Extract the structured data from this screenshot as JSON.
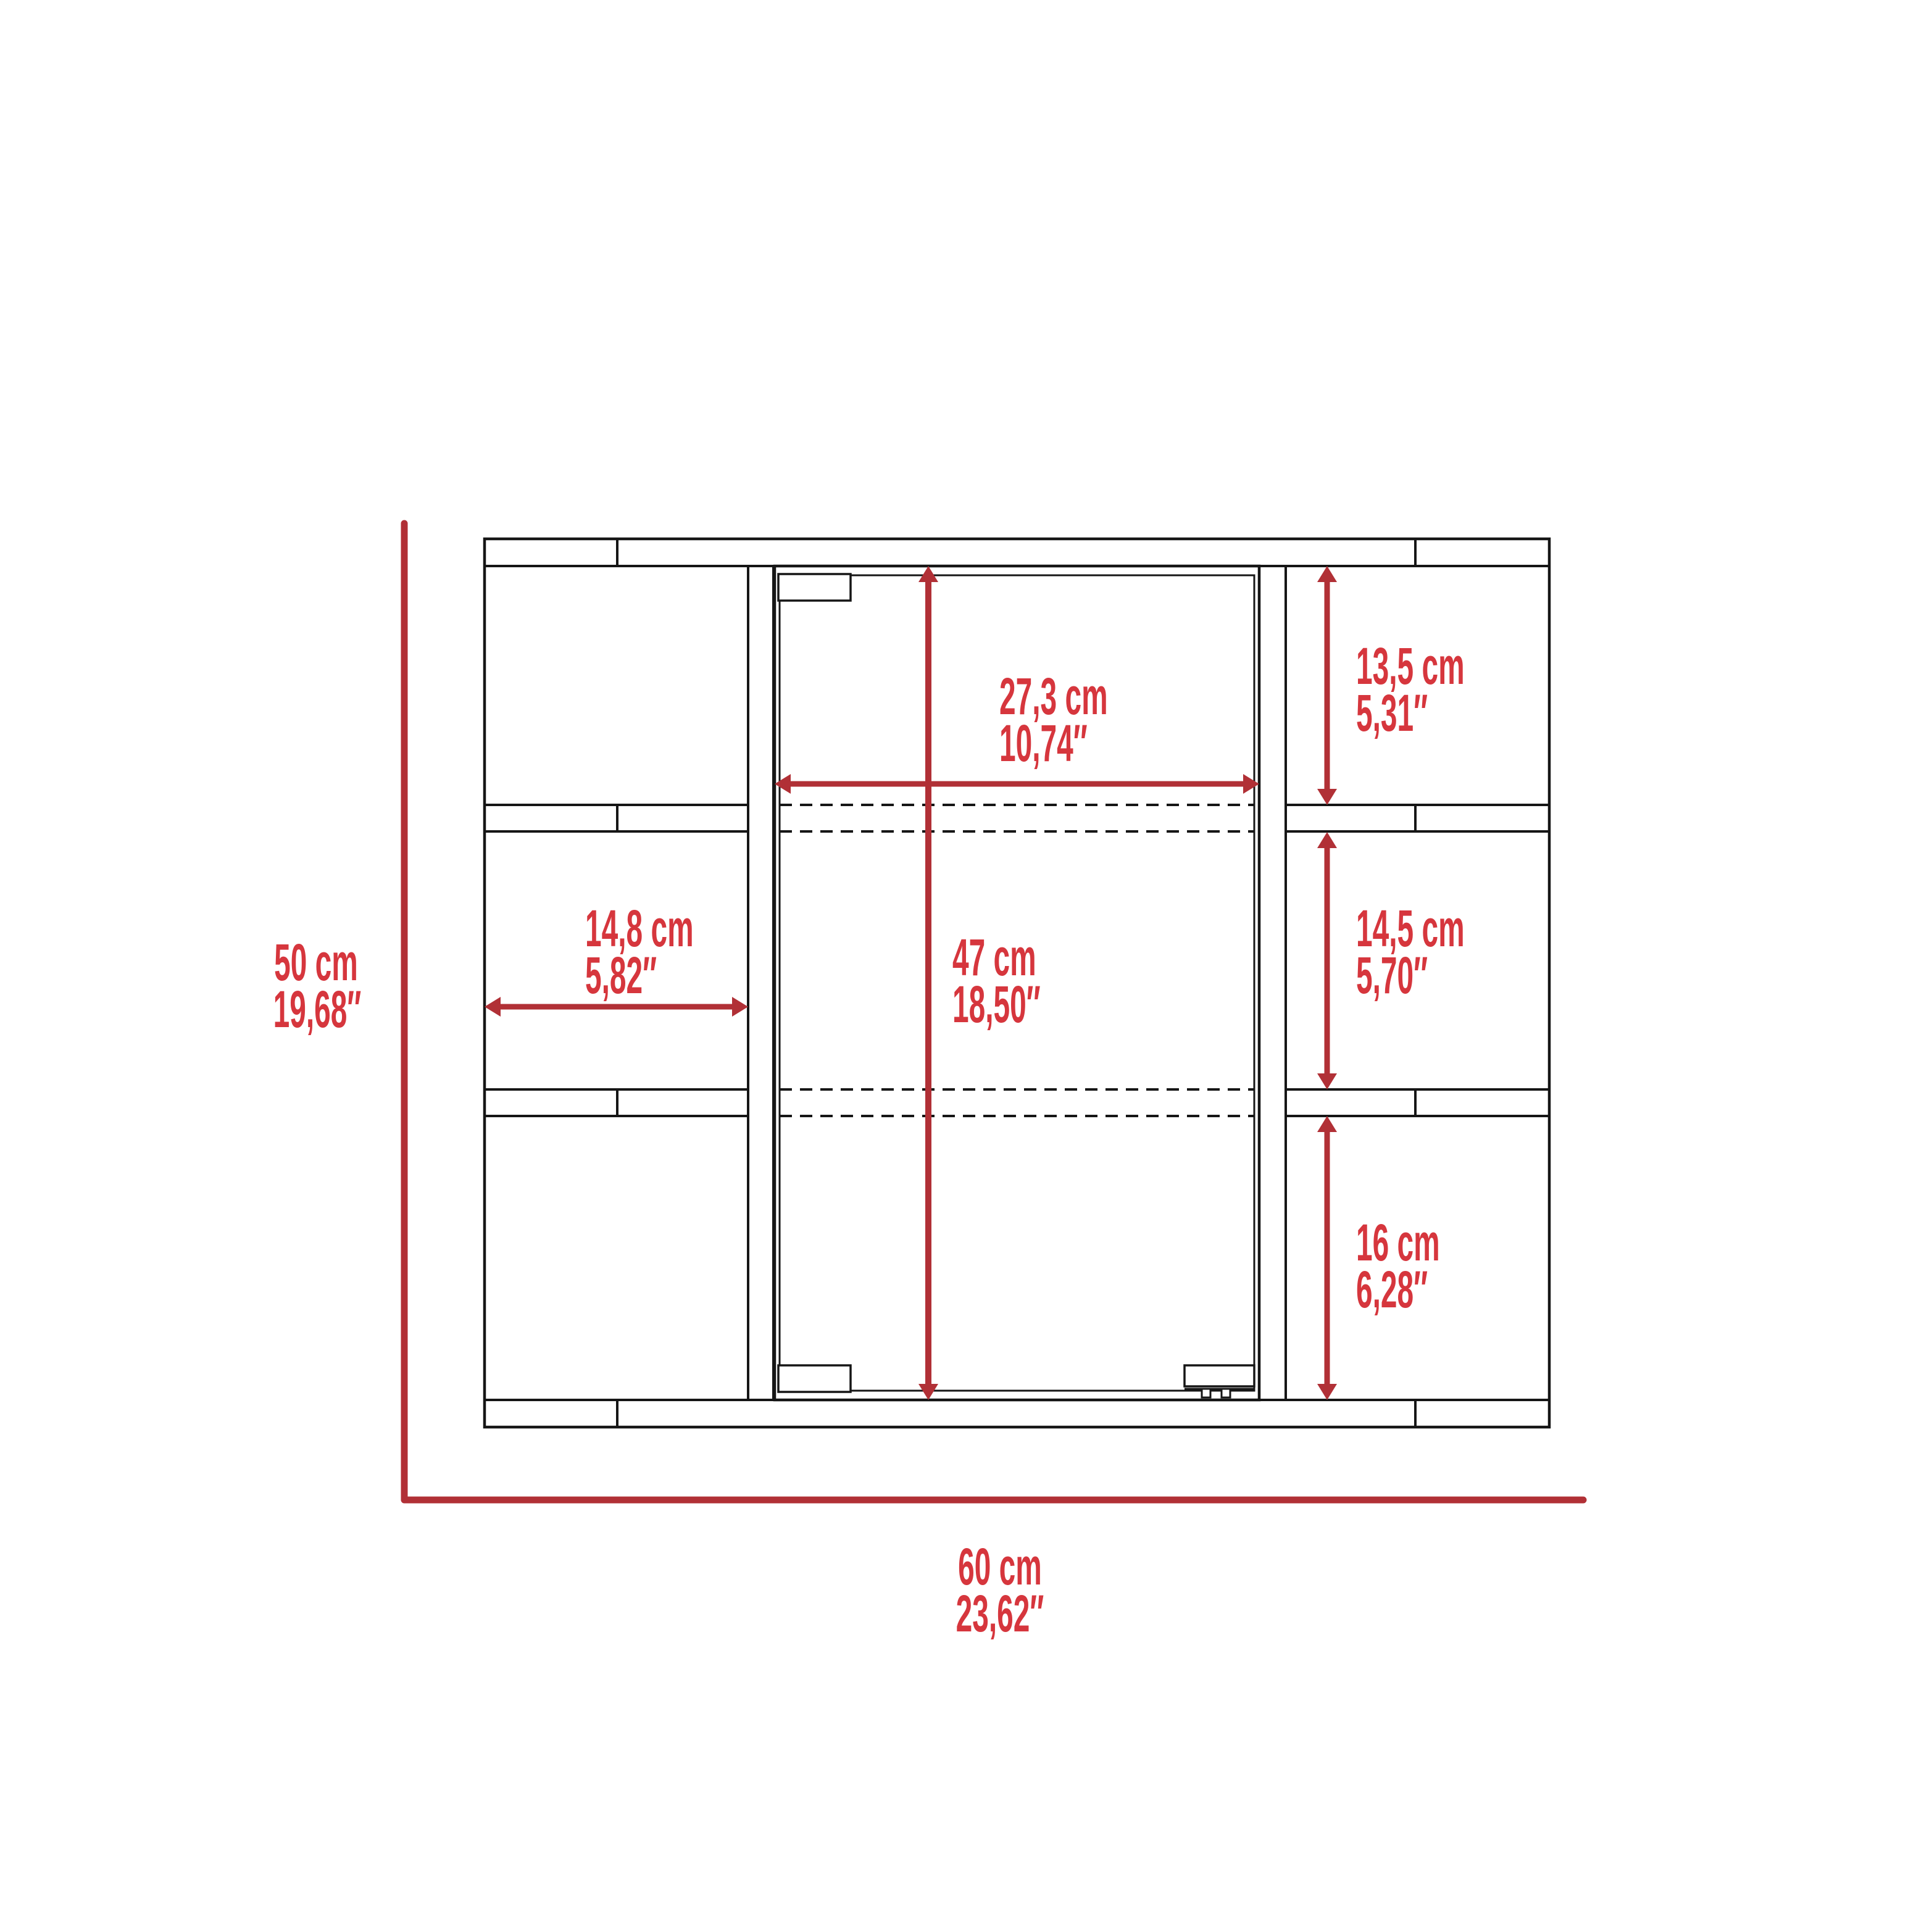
{
  "diagram": {
    "type": "furniture-dimension-drawing",
    "subject": "mirrored medicine wall cabinet, front elevation with six open side shelves and center mirror door",
    "units_format": "metric over imperial"
  },
  "colors": {
    "background": "#ffffff",
    "line_black": "#161616",
    "dimension_red": "#b13036",
    "label_red": "#d6363d"
  },
  "dimensions": {
    "door_width": {
      "cm": "27,3 cm",
      "in": "10,74″"
    },
    "door_height": {
      "cm": "47 cm",
      "in": "18,50″"
    },
    "left_shelf_width": {
      "cm": "14,8 cm",
      "in": "5,82″"
    },
    "right_top_shelf": {
      "cm": "13,5 cm",
      "in": "5,31″"
    },
    "right_middle_shelf": {
      "cm": "14,5 cm",
      "in": "5,70″"
    },
    "right_bottom_shelf": {
      "cm": "16 cm",
      "in": "6,28″"
    },
    "overall_height": {
      "cm": "50 cm",
      "in": "19,68″"
    },
    "overall_width": {
      "cm": "60 cm",
      "in": "23,62″"
    }
  }
}
